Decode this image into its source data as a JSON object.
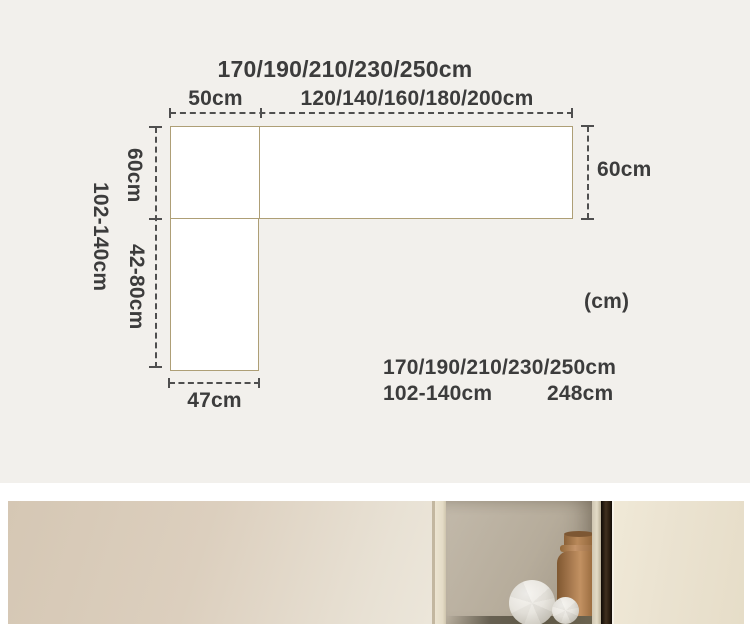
{
  "diagram": {
    "title": "170/190/210/230/250cm",
    "top_left": "50cm",
    "top_right": "120/140/160/180/200cm",
    "left_upper": "60cm",
    "left_overall": "102-140cm",
    "left_lower": "42-80cm",
    "right": "60cm",
    "bottom": "47cm",
    "unit": "(cm)",
    "summary_sizes": "170/190/210/230/250cm",
    "summary_depth": "102-140cm",
    "summary_width": "248cm"
  },
  "colors": {
    "diagram_background": "#f2f0ec",
    "outline": "#ae9f76",
    "text": "#3c3c3c",
    "dash": "#4f4f4f",
    "surface_fill": "#ffffff",
    "photo_wall": "#ddd0c0",
    "photo_niche": "#b6ac9b",
    "photo_vase": "#b98a5c",
    "photo_dark_gap": "#2a1d10",
    "photo_panel": "#ebe3d1"
  }
}
